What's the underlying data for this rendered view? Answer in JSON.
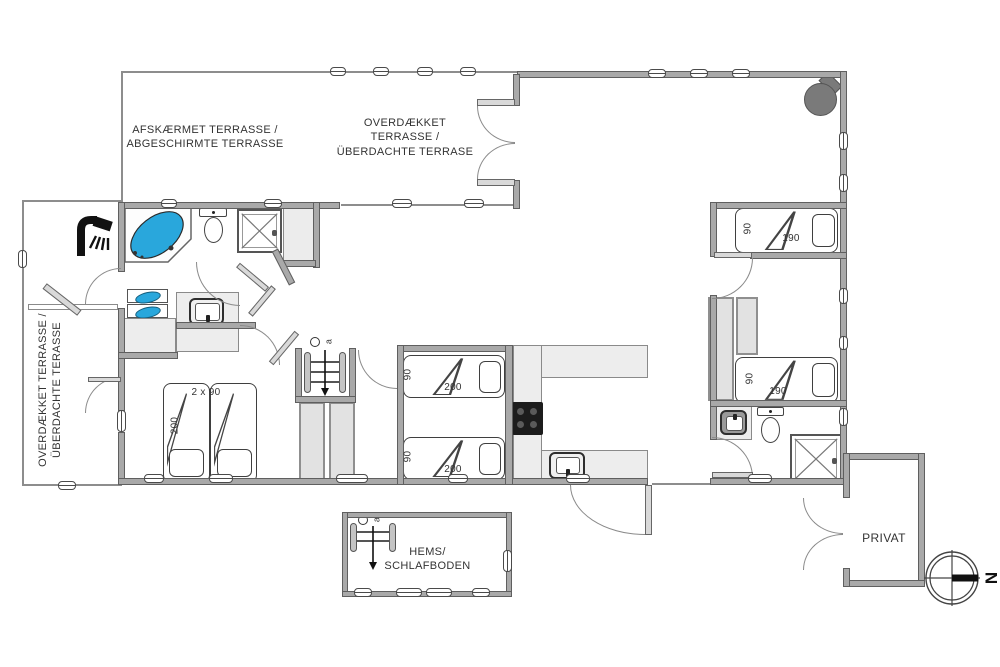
{
  "plan": {
    "terrace_screened": [
      "AFSKÆRMET TERRASSE /",
      "ABGESCHIRMTE TERRASSE"
    ],
    "terrace_covered_top": [
      "OVERDÆKKET",
      "TERRASSE /",
      "ÜBERDACHTE TERRASE"
    ],
    "terrace_covered_left": [
      "OVERDÆKKET TERRASSE /",
      "ÜBERDACHTE TERASSE"
    ],
    "loft_room": [
      "HEMS/",
      "SCHLAFBODEN"
    ],
    "private_room": "PRIVAT",
    "compass_north": "N",
    "ladder_marker": "a",
    "beds": {
      "double": {
        "width": "2 x 90",
        "length": "200"
      },
      "middle_top": {
        "width": "90",
        "length": "200"
      },
      "middle_bottom": {
        "width": "90",
        "length": "200"
      },
      "east_top": {
        "width": "90",
        "length": "190"
      },
      "east_bottom": {
        "width": "90",
        "length": "190"
      }
    },
    "colors": {
      "wall": "#a9a9a9",
      "tub_blue": "#29a7dc",
      "cooktop_black": "#1c1c1c",
      "wood_stove": "#7a7a7a"
    }
  }
}
